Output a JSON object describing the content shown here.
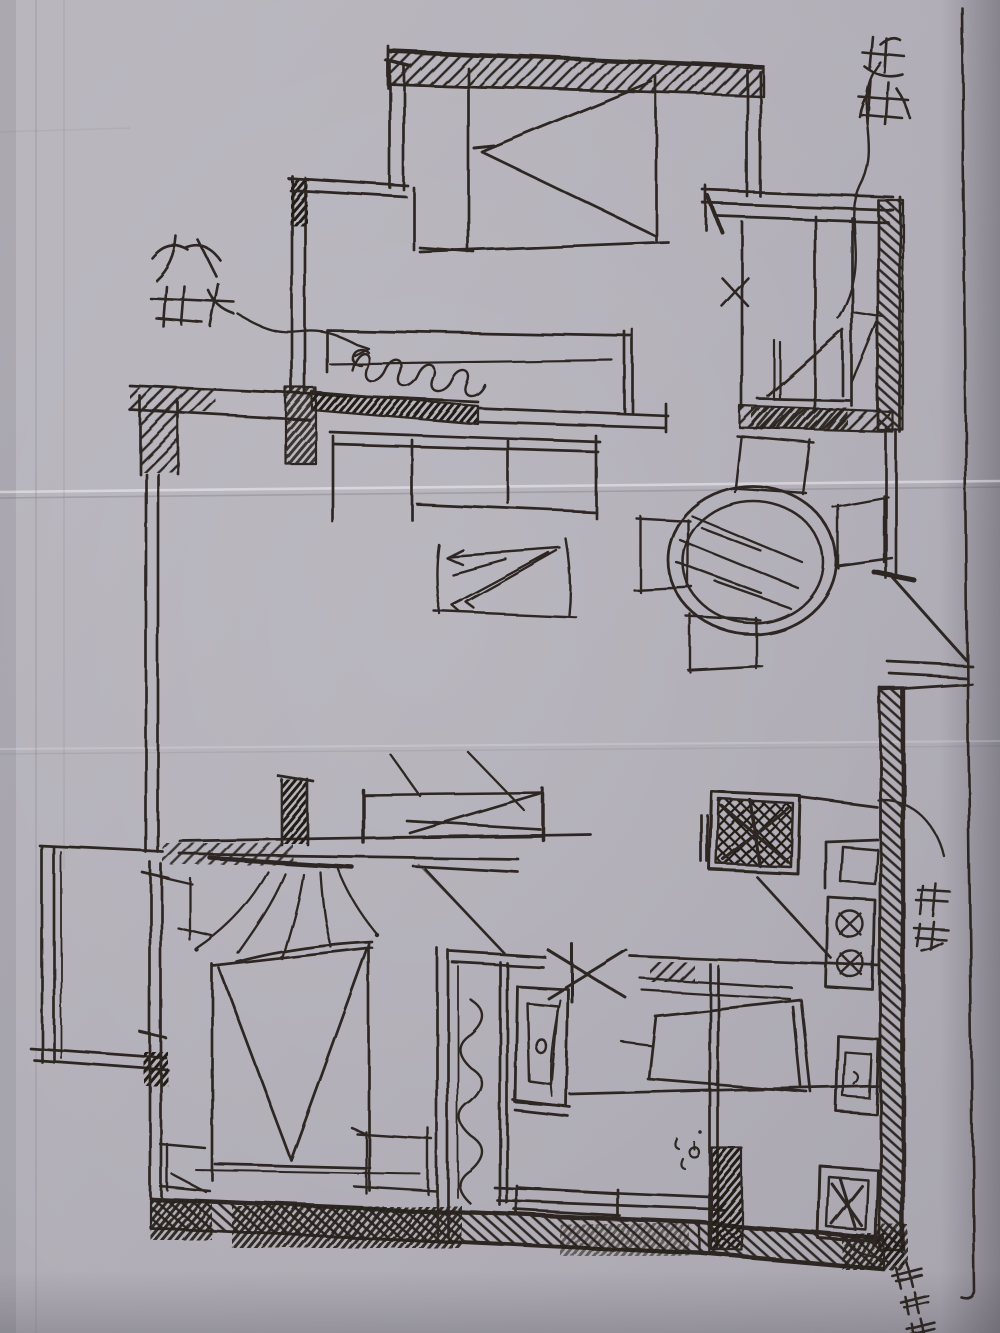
{
  "meta": {
    "description": "Photograph of a hand-drawn apartment floor-plan sketch, black ink on folded grey paper",
    "width_px": 1000,
    "height_px": 1333
  },
  "palette": {
    "paper": "#b3b0b8",
    "paper_shadow": "#8d8a94",
    "ink": "#2f2822",
    "pencil": "#7e7b86"
  },
  "annotations": {
    "upper_left": {
      "text": "补柜",
      "style": "handwritten, leader line pointing to wavy radiator/seat"
    },
    "top_right": {
      "text": "衣柜",
      "style": "handwritten, wavy leader line down into wardrobe"
    },
    "right_middle": {
      "text": "鞋柜",
      "style": "handwritten, rotated 90°, outside right wall"
    },
    "bottom_right": {
      "text": "洗衣机",
      "style": "handwritten, rotated diagonal, leader from corner appliance"
    }
  },
  "elements": [
    "hatched walls",
    "double bed with V fold",
    "bed with bow-tie fold",
    "wardrobe with dividers",
    "round dining table with hatching and four chairs",
    "wavy radiator seat",
    "sliding door",
    "door swing fan",
    "entry door triangle",
    "shower squiggle",
    "toilet",
    "wash basin",
    "fridge with scribble",
    "two-burner stove",
    "two sinks",
    "washing machine",
    "floor drain",
    "balcony bay window",
    "rug with diagonal hatch",
    "paper fold creases"
  ]
}
